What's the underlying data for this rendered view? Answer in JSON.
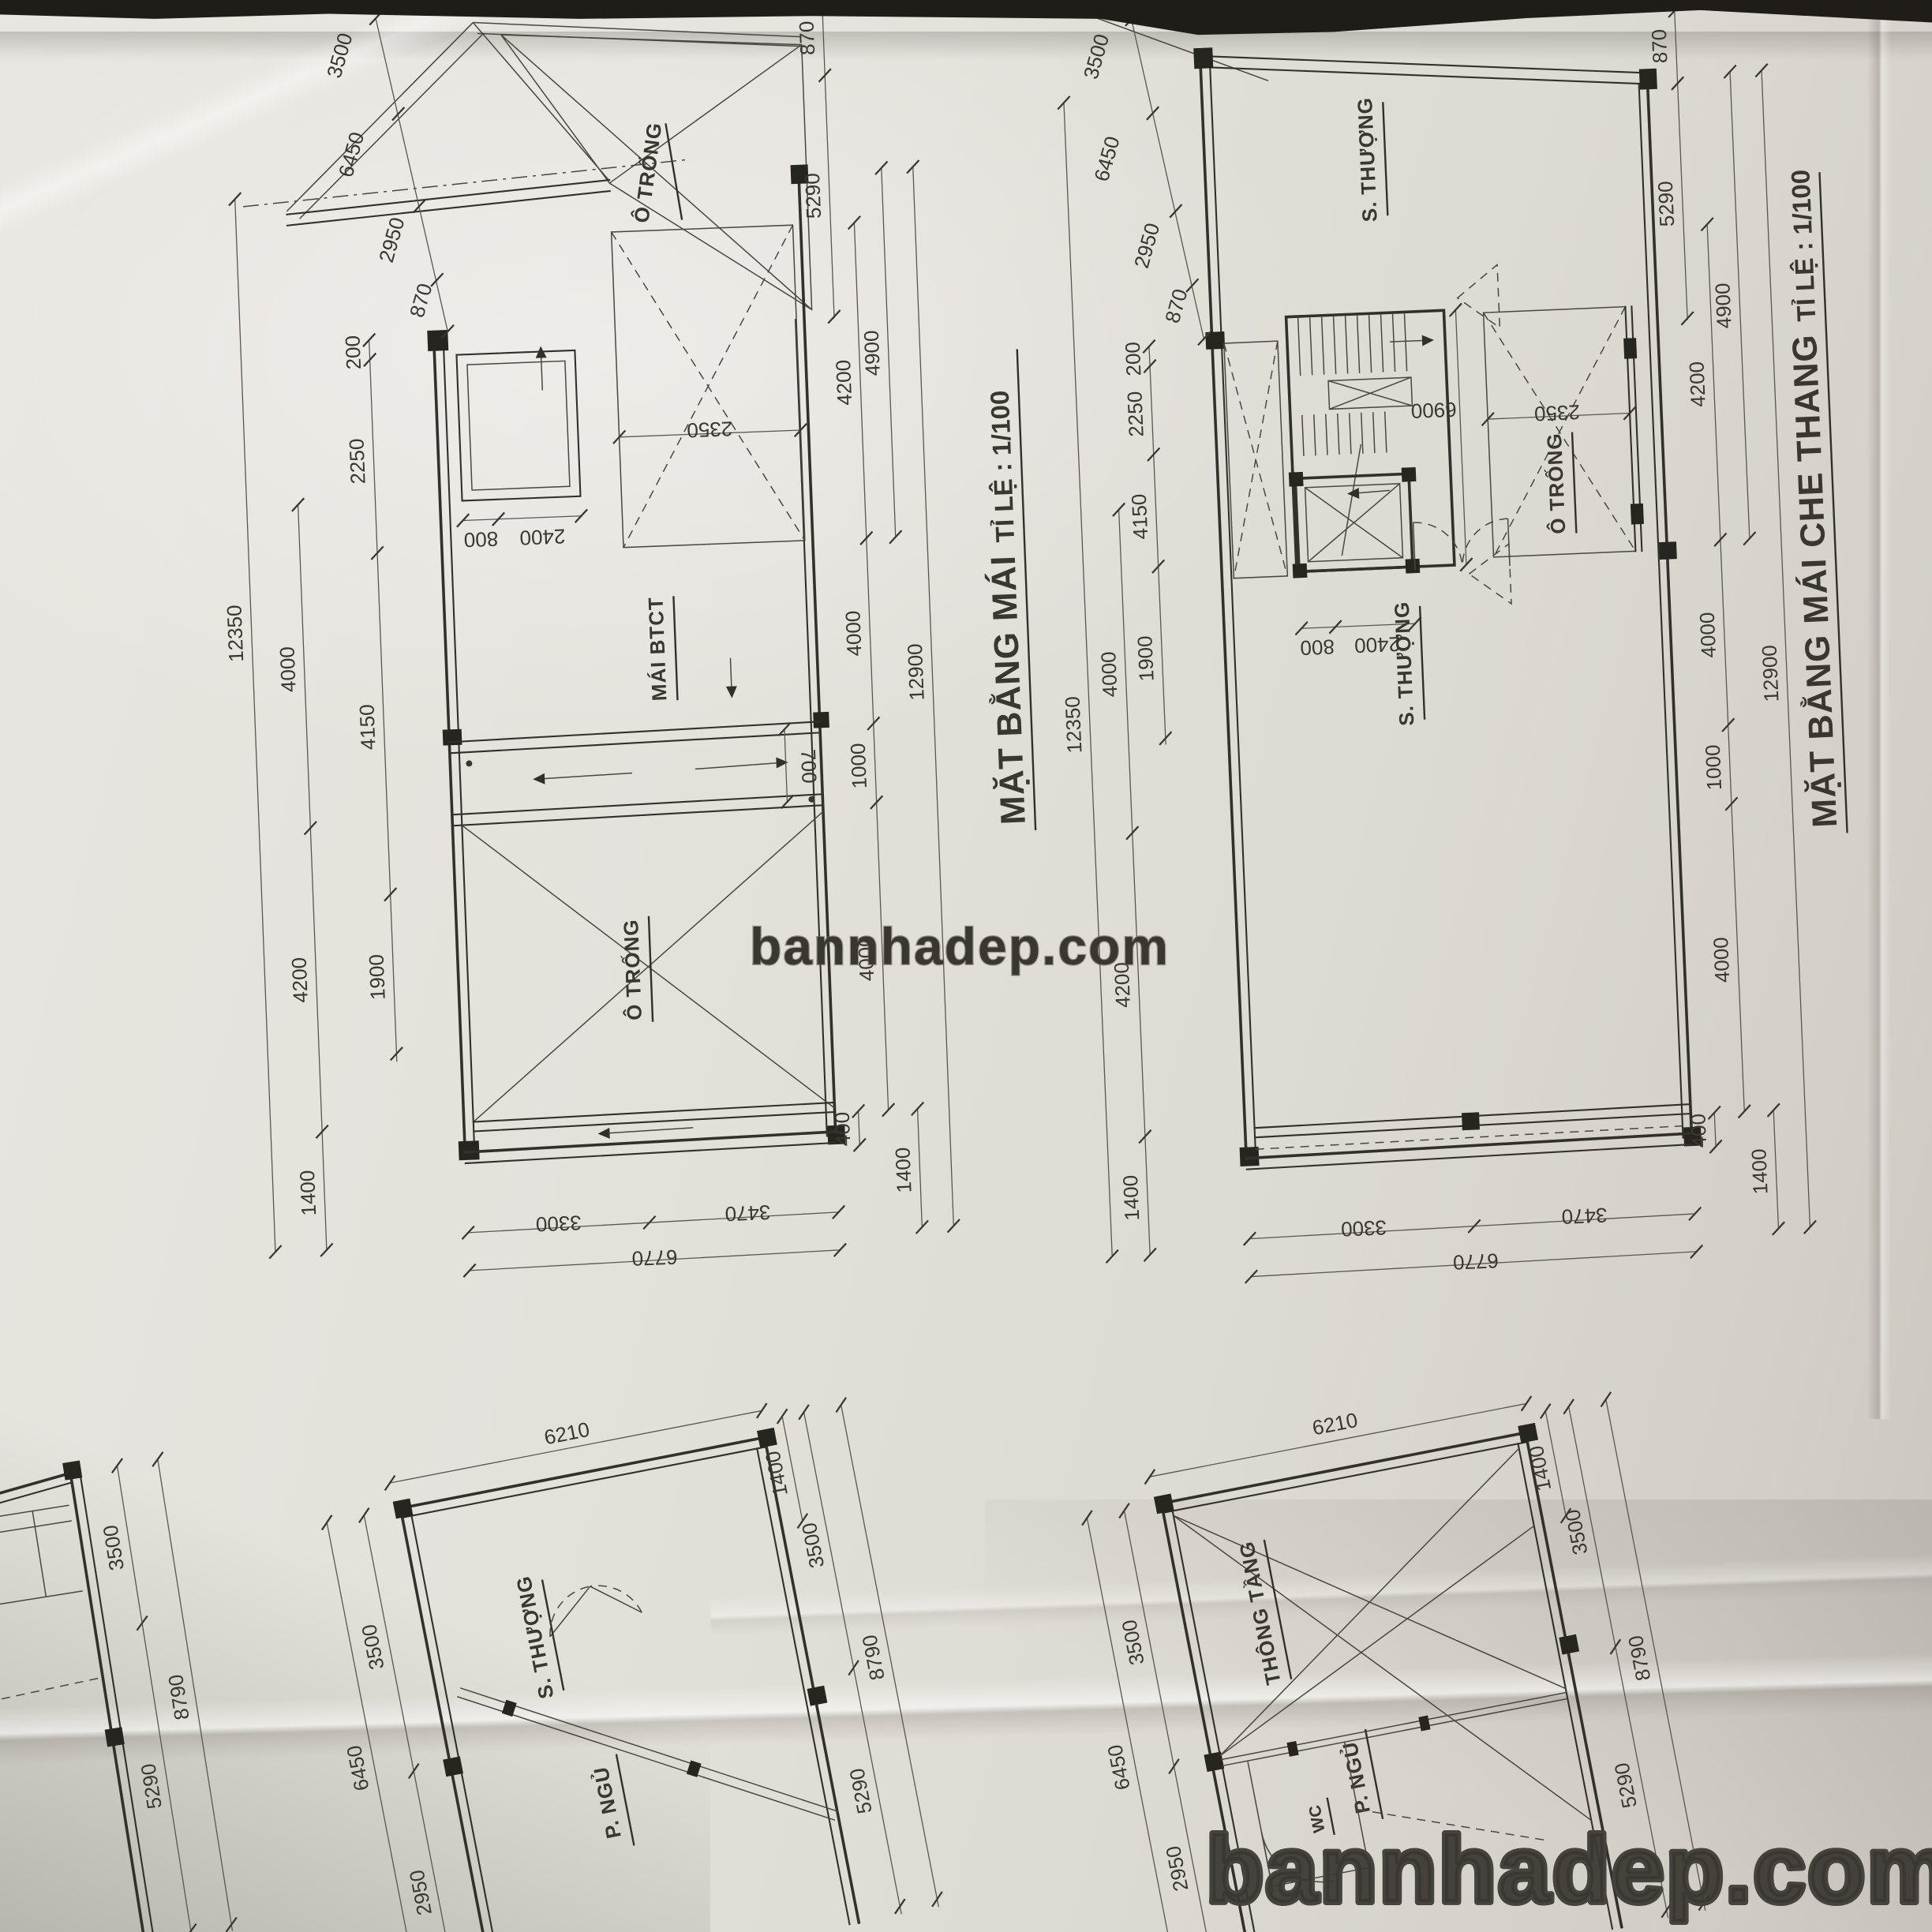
{
  "watermarks": {
    "center": "bannhadep.com",
    "bottom": "bannhadep.com"
  },
  "roof_plan": {
    "title": "MẶT BẰNG MÁI",
    "scale": "TỈ LỆ : 1/100",
    "rooms": {
      "o_trong_top": "Ô TRỐNG",
      "mai_btct": "MÁI BTCT",
      "o_trong": "Ô TRỐNG"
    },
    "dims": {
      "slant": [
        "3500",
        "6450",
        "2950",
        "870"
      ],
      "left_inner": [
        "200",
        "2250",
        "4150",
        "1900"
      ],
      "left_total": "12350",
      "left_col": [
        "4000",
        "4200",
        "1400"
      ],
      "box": [
        "800",
        "2400"
      ],
      "void": "2350",
      "gutter": "700",
      "right_top": [
        "870",
        "5290"
      ],
      "right_inner": [
        "4200",
        "4000",
        "1000",
        "4000"
      ],
      "right_49": "4900",
      "right_total": "12900",
      "right_bottom": [
        "400",
        "1400"
      ],
      "bottom": [
        "3300",
        "3470"
      ],
      "bottom_total": "6770"
    }
  },
  "stair_plan": {
    "title": "MẶT BẰNG MÁI CHE THANG",
    "scale": "TỈ LỆ : 1/100",
    "rooms": {
      "s_thuong_top": "S. THƯỢNG",
      "o_trong": "Ô TRỐNG",
      "s_thuong": "S. THƯỢNG"
    },
    "dims": {
      "slant": [
        "3500",
        "6450",
        "2950",
        "870"
      ],
      "left_inner": [
        "200",
        "2250",
        "4150",
        "1900"
      ],
      "left_total": "12350",
      "left_col": [
        "4000",
        "4200",
        "1400"
      ],
      "box": [
        "800",
        "2400"
      ],
      "stair": "6900",
      "void": "2350",
      "right_top": [
        "870",
        "5290"
      ],
      "right_inner": [
        "4200",
        "4000",
        "1000",
        "4000"
      ],
      "right_49": "4900",
      "right_total": "12900",
      "right_bottom": [
        "400",
        "1400"
      ],
      "bottom": [
        "3300",
        "3470"
      ],
      "bottom_total": "6770"
    }
  },
  "frag_left": {
    "dims": {
      "chain": [
        "3500",
        "8790",
        "5290"
      ]
    }
  },
  "frag_center": {
    "rooms": {
      "s_thuong": "S. THƯỢNG",
      "p_ngu": "P. NGỦ"
    },
    "dims": {
      "top": "6210",
      "top_right": "1400",
      "right": [
        "3500",
        "8790",
        "5290"
      ],
      "left": [
        "3500",
        "6450",
        "2950"
      ]
    }
  },
  "frag_right": {
    "rooms": {
      "thong_tang": "THÔNG TẦNG",
      "p_ngu": "P. NGỦ",
      "wc": "WC"
    },
    "dims": {
      "top": "6210",
      "top_right": "1400",
      "right": [
        "3500",
        "8790",
        "5290"
      ],
      "left": [
        "3500",
        "6450",
        "2950",
        "870"
      ]
    }
  }
}
